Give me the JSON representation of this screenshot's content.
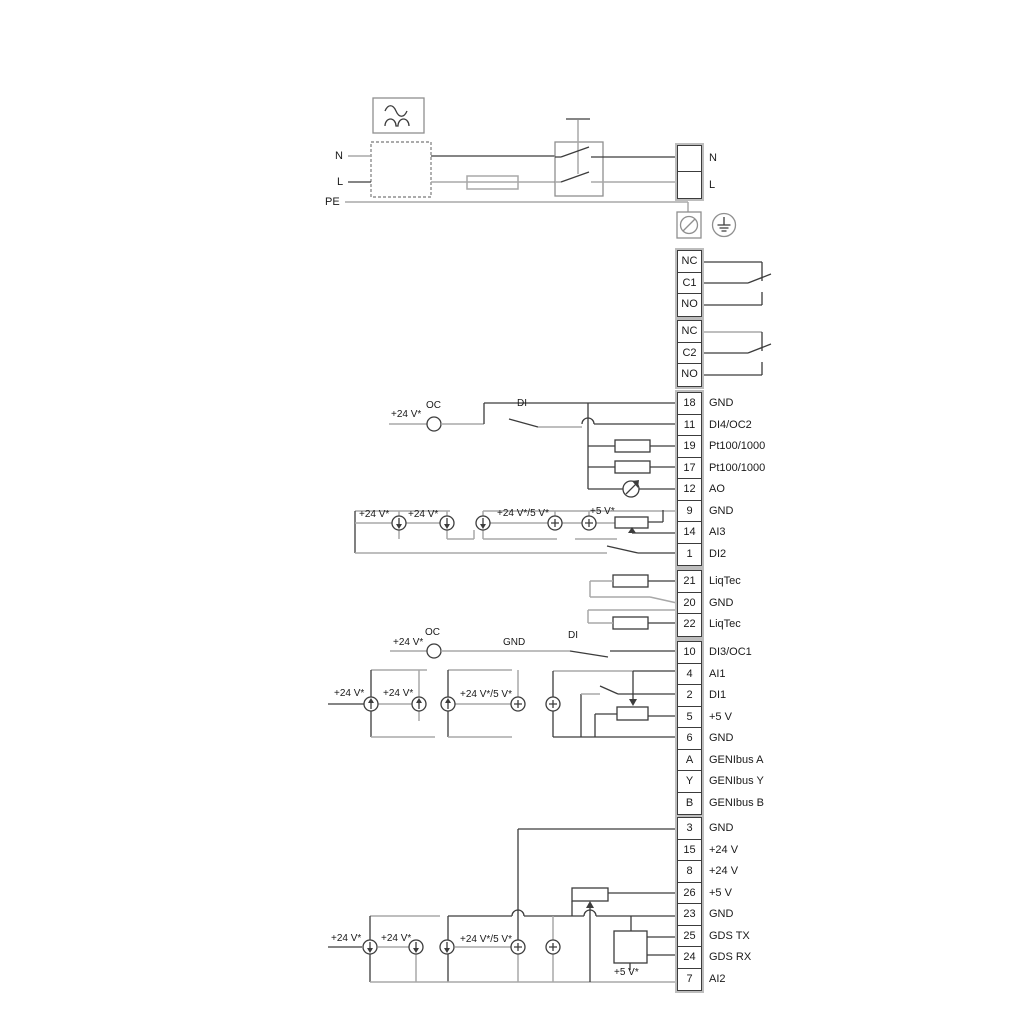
{
  "annotations": {
    "v24": "+24 V*",
    "v24_5": "+24 V*/5 V*",
    "v5": "+5 V*",
    "oc": "OC",
    "di": "DI",
    "gnd": "GND"
  },
  "power": {
    "left": {
      "n": "N",
      "l": "L",
      "pe": "PE"
    },
    "right": {
      "n": "N",
      "l": "L"
    }
  },
  "relay1": {
    "cells": [
      "NC",
      "C1",
      "NO"
    ]
  },
  "relay2": {
    "cells": [
      "NC",
      "C2",
      "NO"
    ]
  },
  "strip_main": {
    "rows": [
      {
        "num": "18",
        "label": "GND"
      },
      {
        "num": "11",
        "label": "DI4/OC2"
      },
      {
        "num": "19",
        "label": "Pt100/1000"
      },
      {
        "num": "17",
        "label": "Pt100/1000"
      },
      {
        "num": "12",
        "label": "AO"
      },
      {
        "num": "9",
        "label": "GND"
      },
      {
        "num": "14",
        "label": "AI3"
      },
      {
        "num": "1",
        "label": "DI2"
      }
    ]
  },
  "strip_liqtec": {
    "rows": [
      {
        "num": "21",
        "label": "LiqTec"
      },
      {
        "num": "20",
        "label": "GND"
      },
      {
        "num": "22",
        "label": "LiqTec"
      }
    ]
  },
  "strip_io": {
    "rows": [
      {
        "num": "10",
        "label": "DI3/OC1"
      },
      {
        "num": "4",
        "label": "AI1"
      },
      {
        "num": "2",
        "label": "DI1"
      },
      {
        "num": "5",
        "label": "+5 V"
      },
      {
        "num": "6",
        "label": "GND"
      },
      {
        "num": "A",
        "label": "GENIbus A"
      },
      {
        "num": "Y",
        "label": "GENIbus Y"
      },
      {
        "num": "B",
        "label": "GENIbus B"
      }
    ]
  },
  "strip_power_io": {
    "rows": [
      {
        "num": "3",
        "label": "GND"
      },
      {
        "num": "15",
        "label": "+24 V"
      },
      {
        "num": "8",
        "label": "+24 V"
      },
      {
        "num": "26",
        "label": "+5 V"
      },
      {
        "num": "23",
        "label": "GND"
      },
      {
        "num": "25",
        "label": "GDS TX"
      },
      {
        "num": "24",
        "label": "GDS RX"
      },
      {
        "num": "7",
        "label": "AI2"
      }
    ]
  }
}
